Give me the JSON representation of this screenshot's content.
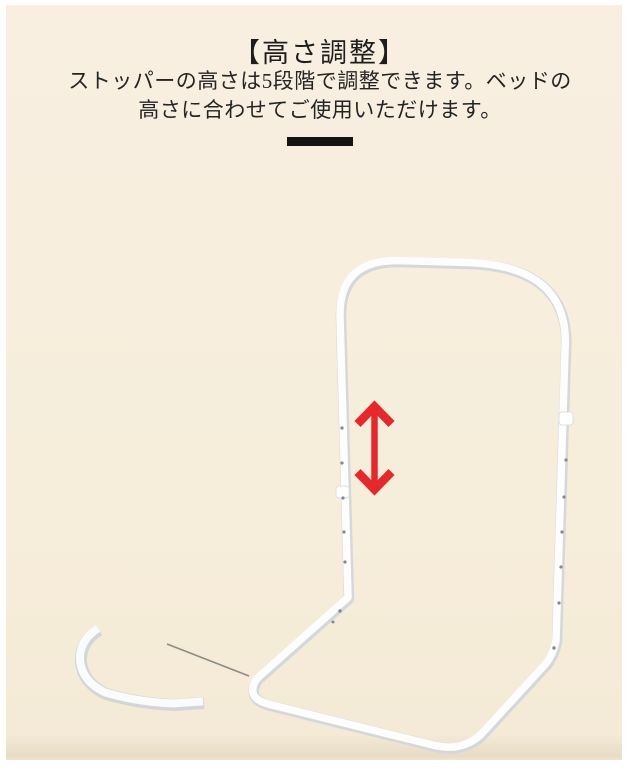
{
  "page": {
    "background_color": "#ffffff",
    "canvas_background_color": "#f6edda"
  },
  "header": {
    "title": "【高さ調整】",
    "description_line1": "ストッパーの高さは5段階で調整できます。ベッドの",
    "description_line2": "高さに合わせてご使用いただけます。"
  },
  "illustration": {
    "subject": "height-adjustable bed guard rail frame",
    "arrow_icon": "double-vertical-arrow",
    "arrow_color": "#e5282c",
    "frame_color": "#fdfdfd",
    "frame_shadow_color": "#d5d8db"
  }
}
